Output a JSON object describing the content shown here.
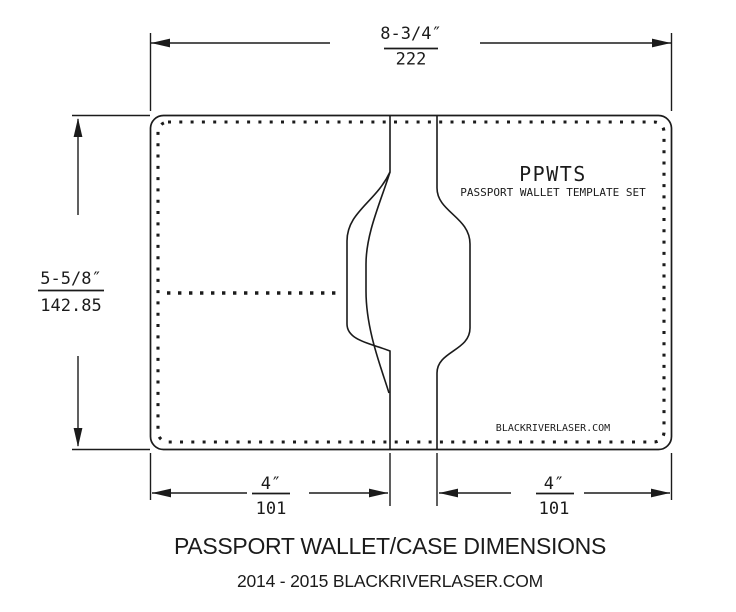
{
  "colors": {
    "background": "#ffffff",
    "line": "#1b1b1b",
    "text": "#1b1b1b"
  },
  "drawing": {
    "top_dimension": {
      "inches": "8-3/4″",
      "mm": "222"
    },
    "left_dimension": {
      "inches": "5-5/8″",
      "mm": "142.85"
    },
    "bottom_left_dimension": {
      "inches": "4″",
      "mm": "101"
    },
    "bottom_right_dimension": {
      "inches": "4″",
      "mm": "101"
    },
    "label": {
      "code": "PPWTS",
      "name": "PASSPORT WALLET TEMPLATE SET"
    },
    "watermark": "BLACKRIVERLASER.COM"
  },
  "caption": {
    "title": "PASSPORT WALLET/CASE DIMENSIONS",
    "subtitle": "2014 - 2015 BLACKRIVERLASER.COM"
  }
}
